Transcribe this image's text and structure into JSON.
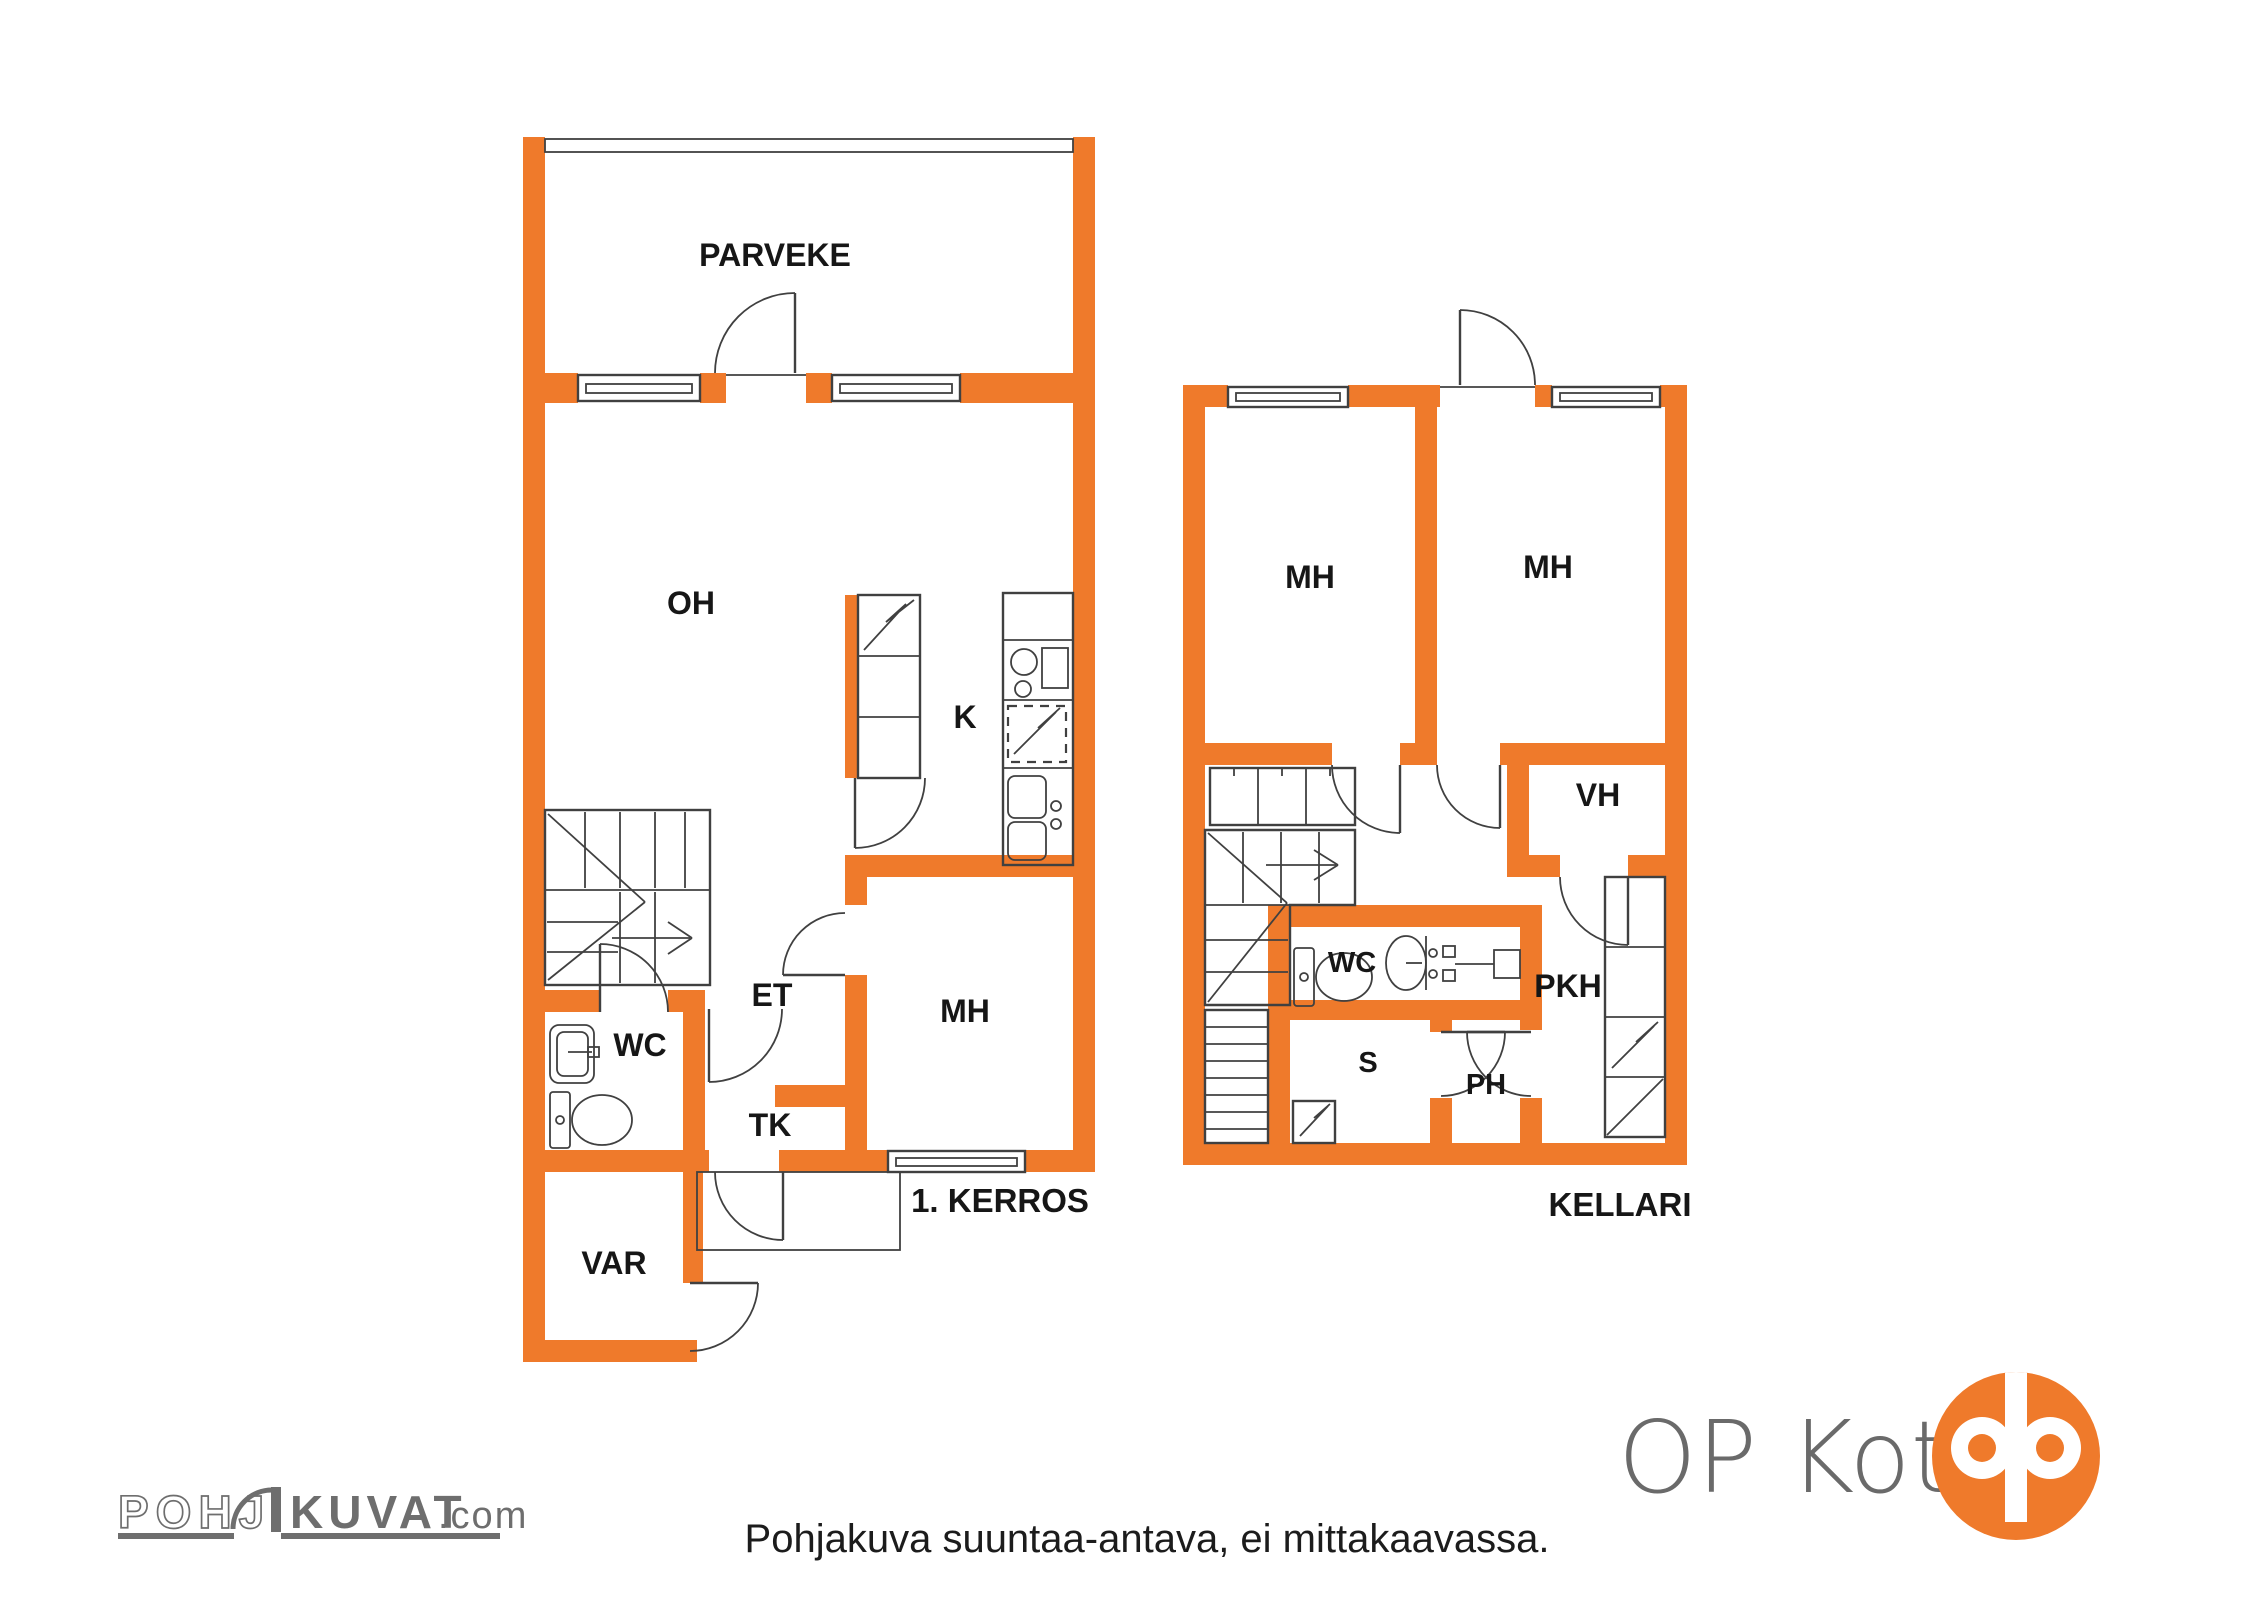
{
  "floor1": {
    "title": "1. KERROS",
    "rooms": {
      "parveke": "PARVEKE",
      "oh": "OH",
      "k": "K",
      "et": "ET",
      "mh": "MH",
      "wc": "WC",
      "tk": "TK",
      "var": "VAR"
    }
  },
  "floor2": {
    "title": "KELLARI",
    "rooms": {
      "mh_left": "MH",
      "mh_right": "MH",
      "vh": "VH",
      "wc": "WC",
      "pkh": "PKH",
      "s": "S",
      "ph": "PH"
    }
  },
  "footer": {
    "disclaimer": "Pohjakuva suuntaa-antava, ei mittakaavassa."
  },
  "branding": {
    "pohjakuvat_part1": "POHJ",
    "pohjakuvat_part2": "KUVAT",
    "pohjakuvat_suffix": ".com",
    "op_koti": "OP Koti"
  },
  "colors": {
    "wall_orange": "#EF7A2B",
    "line_gray": "#404040",
    "logo_gray": "#6E6E6E",
    "text_black": "#161616"
  }
}
